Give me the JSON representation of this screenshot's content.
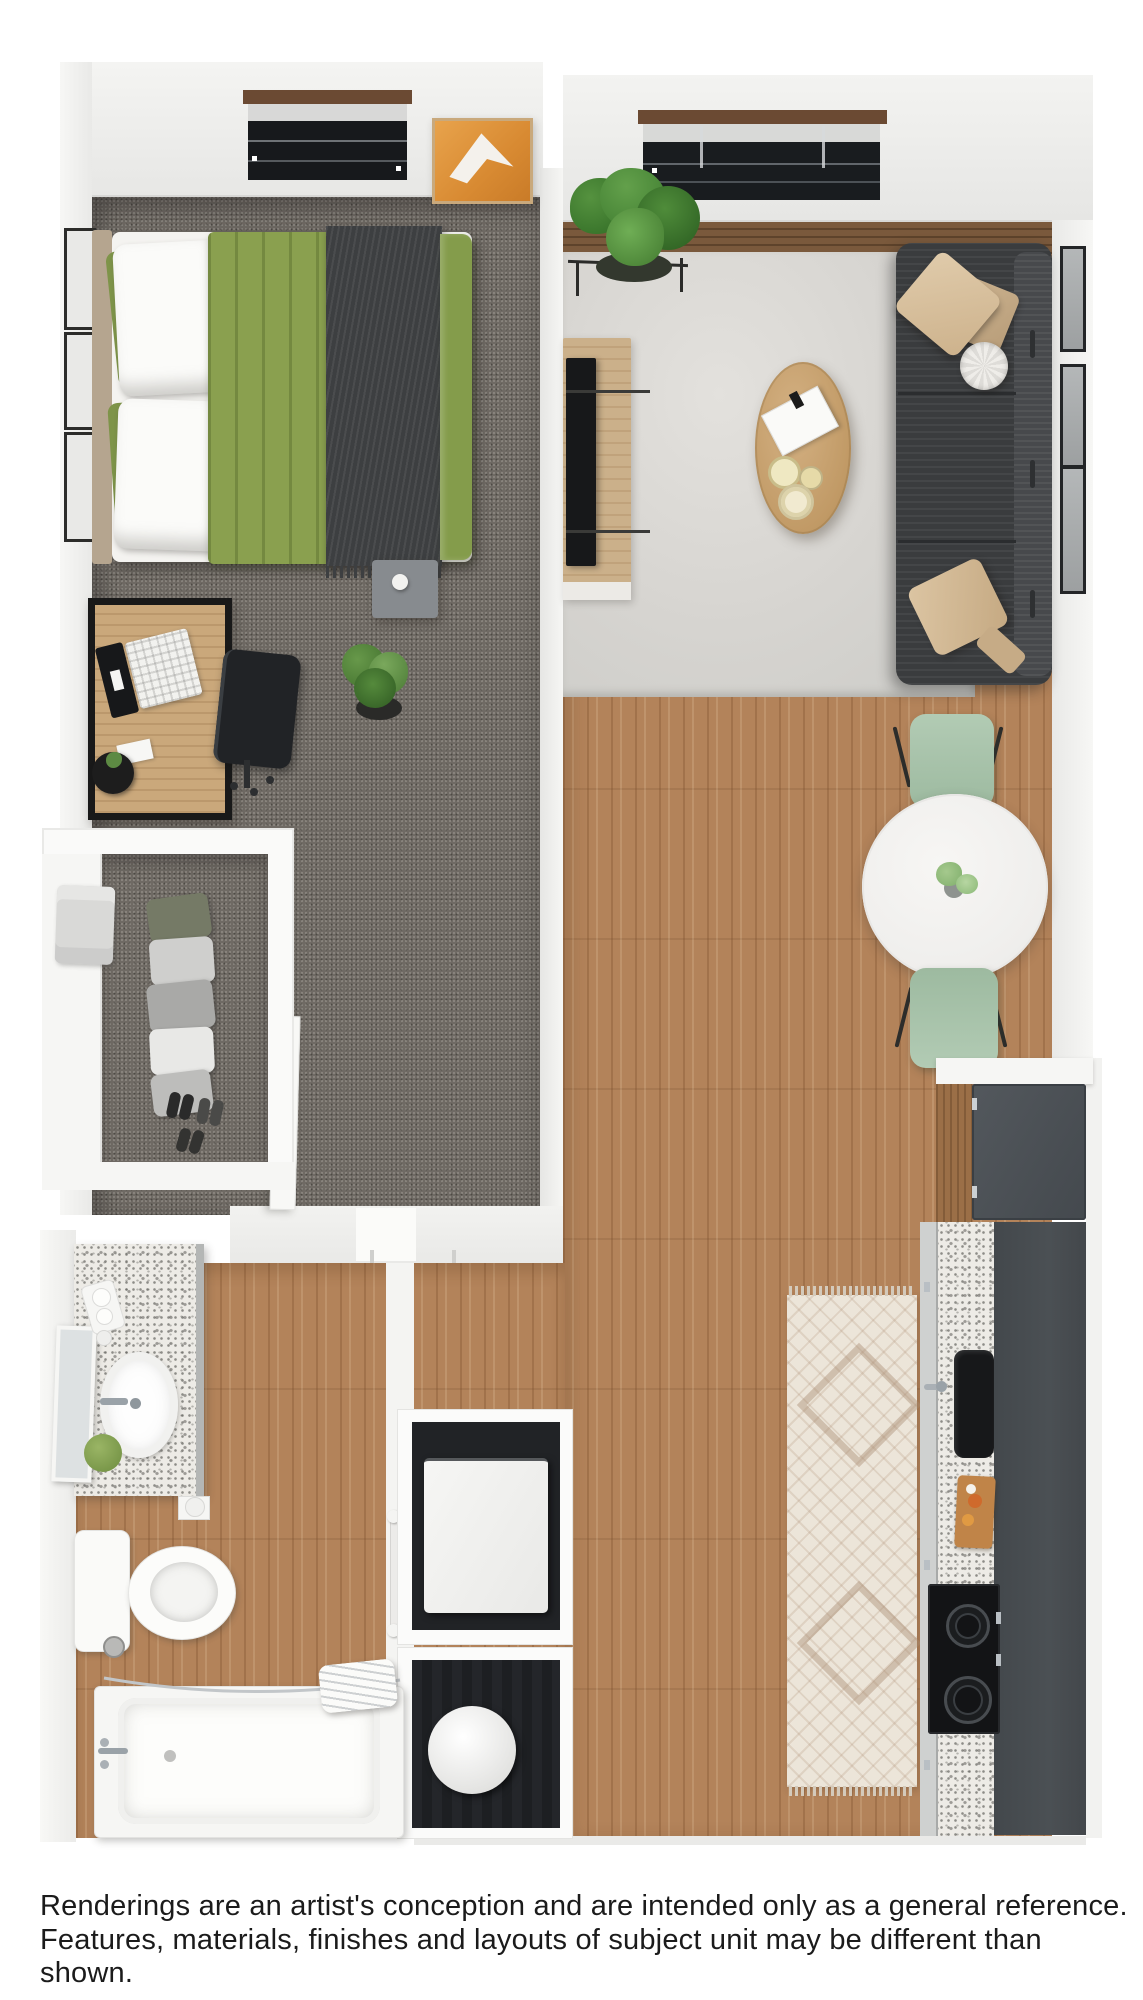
{
  "disclaimer": {
    "line1": "Renderings are an artist's conception and are intended only as a general reference.",
    "line2": "Features, materials, finishes and layouts of subject unit may be different than shown."
  },
  "floor_plan": {
    "title": "studio-apartment-3d-floor-plan-rendering",
    "rooms": [
      {
        "name": "bedroom",
        "items": [
          "window",
          "orange-wall-art",
          "wall-frames",
          "bed",
          "green-duvet",
          "charcoal-throw",
          "nightstand",
          "desk",
          "laptop",
          "office-chair",
          "potted-plant",
          "carpet-floor"
        ]
      },
      {
        "name": "walk-in-closet",
        "items": [
          "shelf",
          "folded-sweater",
          "hanging-clothes",
          "shoes"
        ]
      },
      {
        "name": "living-room",
        "items": [
          "window",
          "corner-plant",
          "media-console",
          "tv",
          "area-rug",
          "oval-coffee-table",
          "book",
          "decor-bowls",
          "sofa",
          "tan-pillows",
          "round-pillow",
          "gallery-frames"
        ]
      },
      {
        "name": "dining-area",
        "items": [
          "round-white-table",
          "centerpiece-plant",
          "sage-chair-top",
          "sage-chair-bottom"
        ]
      },
      {
        "name": "kitchen",
        "items": [
          "refrigerator",
          "wood-cabinet",
          "granite-counter",
          "black-sink",
          "faucet",
          "cutting-board",
          "cooktop",
          "runner-rug",
          "dark-counter"
        ]
      },
      {
        "name": "laundry-closet",
        "items": [
          "washer",
          "utility-round-unit",
          "towel-bar"
        ]
      },
      {
        "name": "bathroom",
        "items": [
          "granite-vanity",
          "oval-sink",
          "mirror",
          "soap-tray",
          "moss-plant",
          "toilet",
          "toilet-paper-holder",
          "floor-drain",
          "bathtub",
          "tub-faucet",
          "shower-rod",
          "towel"
        ]
      }
    ],
    "colors": {
      "wall": "#ededeb",
      "carpet": "#6f6a64",
      "wood_floor": "#b3835a",
      "dark_wood_strip": "#7a593c",
      "living_rug": "#d6d4d0",
      "sofa": "#3a3c3e",
      "duvet_green": "#8aa04f",
      "chair_sage": "#a9c4ab",
      "artwork_orange": "#e0963f",
      "granite": "#edebe6",
      "counter_dark": "#43484c",
      "coffee_table_wood": "#c8a576"
    }
  }
}
